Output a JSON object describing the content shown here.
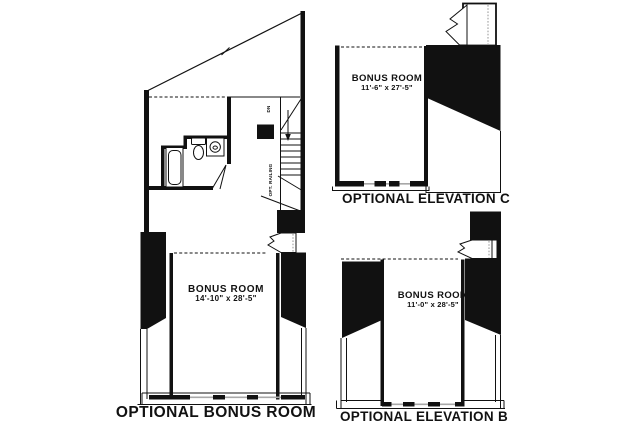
{
  "page": {
    "background": "#ffffff",
    "ink_color": "#111111",
    "drawing_type": "architectural floor plan options"
  },
  "left_plan": {
    "title": "OPTIONAL BONUS ROOM",
    "room": {
      "name": "BONUS ROOM",
      "dimensions": "14'-10\" x 28'-5\""
    },
    "annotations": {
      "down": "DN",
      "railing": "OPT. RAILING"
    }
  },
  "elevation_c": {
    "title": "OPTIONAL ELEVATION C",
    "room": {
      "name": "BONUS ROOM",
      "dimensions": "11'-6\" x 27'-5\""
    }
  },
  "elevation_b": {
    "title": "OPTIONAL ELEVATION B",
    "room": {
      "name": "BONUS ROOM",
      "dimensions": "11'-0\" x 28'-5\""
    }
  }
}
